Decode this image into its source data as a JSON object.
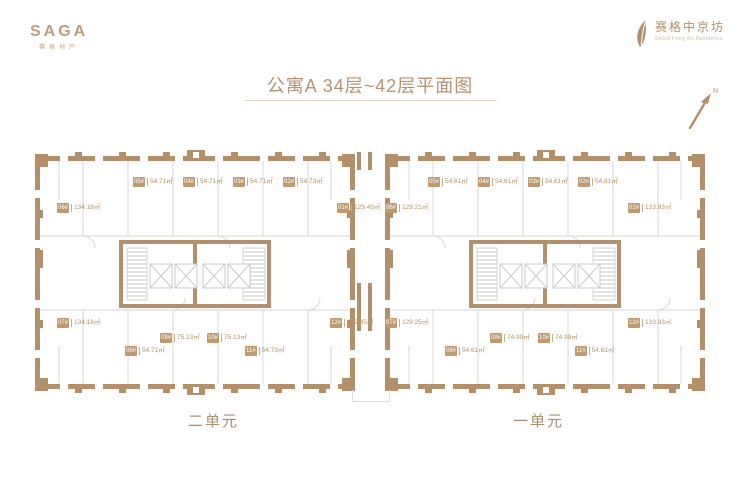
{
  "brand": {
    "logo_main": "SAGA",
    "logo_sub": "赛格地产",
    "project_name": "赛格中京坊",
    "project_sub": "SAGA Feng Art Residence"
  },
  "title": "公寓A 34层~42层平面图",
  "compass_label": "N",
  "plan": {
    "unit2": {
      "name": "二单元",
      "labels": [
        {
          "tag": "06#",
          "area": "134.18㎡"
        },
        {
          "tag": "05#",
          "area": "54.71㎡"
        },
        {
          "tag": "04#",
          "area": "54.71㎡"
        },
        {
          "tag": "03#",
          "area": "54.71㎡"
        },
        {
          "tag": "02#",
          "area": "54.73㎡"
        },
        {
          "tag": "01#",
          "area": "129.45㎡"
        },
        {
          "tag": "07#",
          "area": "134.18㎡"
        },
        {
          "tag": "08#",
          "area": "54.71㎡"
        },
        {
          "tag": "09#",
          "area": "75.13㎡"
        },
        {
          "tag": "10#",
          "area": "75.13㎡"
        },
        {
          "tag": "11#",
          "area": "54.73㎡"
        },
        {
          "tag": "12#",
          "area": "129.45㎡"
        }
      ]
    },
    "unit1": {
      "name": "一单元",
      "labels": [
        {
          "tag": "06#",
          "area": "129.21㎡"
        },
        {
          "tag": "05#",
          "area": "54.61㎡"
        },
        {
          "tag": "04#",
          "area": "54.61㎡"
        },
        {
          "tag": "03#",
          "area": "54.61㎡"
        },
        {
          "tag": "02#",
          "area": "54.61㎡"
        },
        {
          "tag": "01#",
          "area": "133.93㎡"
        },
        {
          "tag": "07#",
          "area": "129.25㎡"
        },
        {
          "tag": "08#",
          "area": "54.61㎡"
        },
        {
          "tag": "09#",
          "area": "74.99㎡"
        },
        {
          "tag": "10#",
          "area": "74.99㎡"
        },
        {
          "tag": "11#",
          "area": "54.61㎡"
        },
        {
          "tag": "12#",
          "area": "133.93㎡"
        }
      ]
    }
  },
  "colors": {
    "accent": "#b39069",
    "tag_bg": "#c09a6e",
    "line": "#d3d7dd"
  }
}
